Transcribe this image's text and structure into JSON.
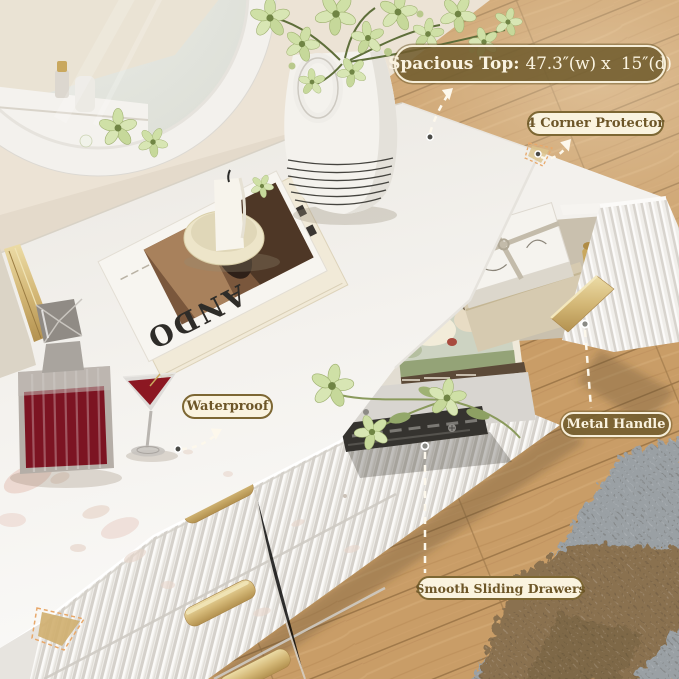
{
  "product_annotations": {
    "spacious_top": {
      "title": "Spacious Top:",
      "dimensions": "47.3″(w) x  15″(d)"
    },
    "corner_protector": {
      "label": "4 Corner Protector"
    },
    "waterproof": {
      "label": "Waterproof"
    },
    "metal_handle": {
      "label": "Metal Handle"
    },
    "sliding_drawers": {
      "label": "Smooth Sliding Drawers"
    }
  },
  "decor": {
    "book_title": "ANDO"
  },
  "colors": {
    "badge_olive": "#715C2D",
    "badge_cream": "#FAF3DF",
    "pill_border_brown": "#7D6733",
    "pill_text_brown": "#6D5628",
    "gold_handle": "#D0B273",
    "wood_floor": "#C89C66",
    "wall": "#ECE3D5",
    "dresser_white": "#F5F3EF",
    "wine_red": "#7C1220"
  }
}
